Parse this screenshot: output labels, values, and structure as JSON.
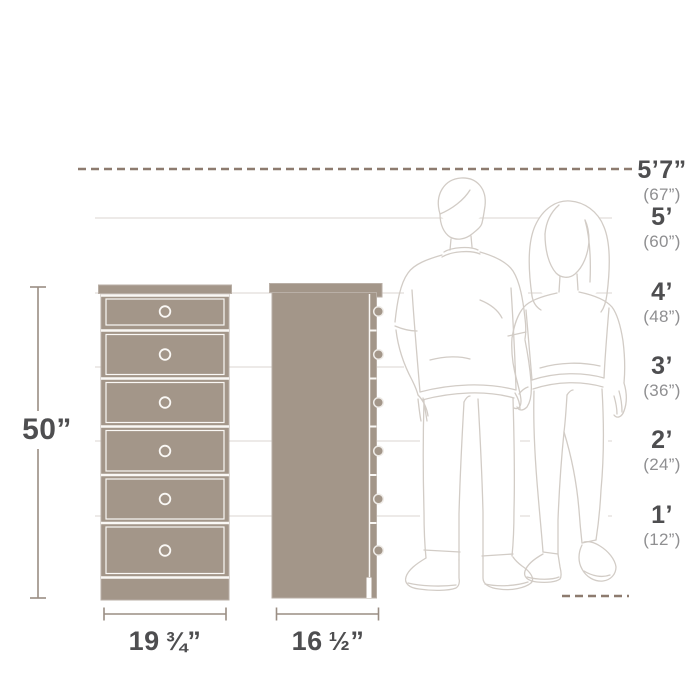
{
  "diagram": {
    "type": "furniture-dimension-diagram",
    "subject": "6-drawer tall chest shown in front view and side view beside human figures for scale"
  },
  "height_ruler": {
    "rows": [
      {
        "feet": "5’7”",
        "inches": "(67”)"
      },
      {
        "feet": "5’",
        "inches": "(60”)"
      },
      {
        "feet": "4’",
        "inches": "(48”)"
      },
      {
        "feet": "3’",
        "inches": "(36”)"
      },
      {
        "feet": "2’",
        "inches": "(24”)"
      },
      {
        "feet": "1’",
        "inches": "(12”)"
      }
    ]
  },
  "product": {
    "height_label": "50”",
    "front_width": {
      "whole": "19",
      "fraction": "¾",
      "unit": "”"
    },
    "side_depth": {
      "whole": "16",
      "fraction": "½",
      "unit": "”"
    },
    "drawer_count": 6
  },
  "colors": {
    "background": "#ffffff",
    "furniture_fill": "#a39689",
    "furniture_line": "#faf8f5",
    "furniture_edge": "#b9afa6",
    "grid_line": "#e7e4e0",
    "dash_line": "#8d7b6f",
    "dimension_line": "#9a8e84",
    "label_primary": "#4e4e50",
    "label_secondary": "#8f8f91",
    "figure_outline": "#d2ccc6"
  },
  "icons": {
    "front_view": "dresser-front-view-drawing",
    "side_view": "dresser-side-view-drawing",
    "man": "man-outline-figure",
    "woman": "woman-outline-figure"
  }
}
